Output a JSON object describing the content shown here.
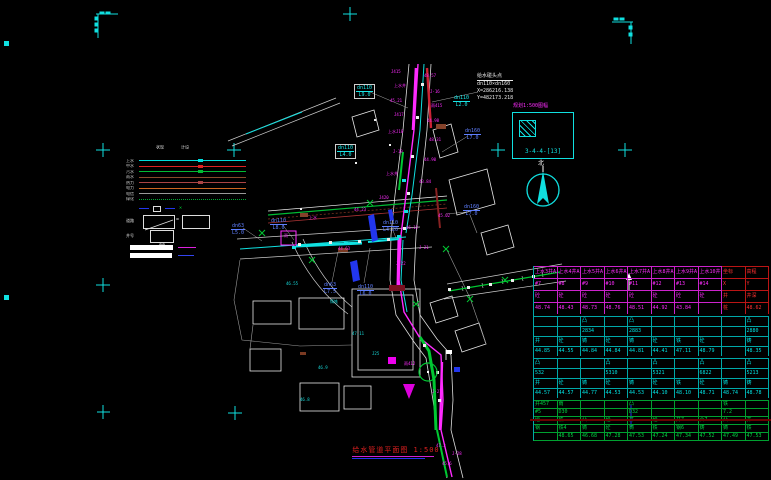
{
  "title": {
    "text": "给水管道平面图 1:500"
  },
  "north": {
    "label": "北"
  },
  "note": {
    "lines": [
      "给水碰头点",
      "dn110×dn160",
      "X=286216.138",
      "Y=482173.218"
    ]
  },
  "detail_box": {
    "title": "规划1:500图幅",
    "label": "3-4-4-[13]"
  },
  "colors": {
    "cyan": "#10e0e0",
    "magenta": "#ff2bff",
    "green": "#00c832",
    "blue_label": "#5f7fff",
    "red": "#e02020",
    "maroon": "#6a0000"
  },
  "legend": {
    "headers": [
      "现状",
      "设计"
    ],
    "rows": [
      {
        "label": "上水",
        "color": "#00dddd",
        "style": "solid",
        "blob": true
      },
      {
        "label": "中水",
        "color": "#dd2222",
        "style": "solid",
        "blob": true
      },
      {
        "label": "污水",
        "color": "#00bb33",
        "style": "solid",
        "blob": true
      },
      {
        "label": "雨水",
        "color": "#8a4a2a",
        "style": "solid",
        "blob": false
      },
      {
        "label": "热力",
        "color": "#aa4444",
        "style": "solid",
        "blob": true
      },
      {
        "label": "电力",
        "color": "#cc6622",
        "style": "solid",
        "blob": false
      },
      {
        "label": "电信",
        "color": "#999999",
        "style": "solid",
        "blob": false
      },
      {
        "label": "绿化",
        "color": "#00aa33",
        "style": "dotted",
        "blob": false
      }
    ],
    "road_label": "道路",
    "well_row_label": "井号",
    "well_label": "AA",
    "equals": "="
  },
  "pipe_labels": [
    {
      "lines": [
        "dn63",
        "L5.0"
      ],
      "x": 231,
      "y": 223,
      "c": "blue"
    },
    {
      "lines": [
        "dn110",
        "L8.0"
      ],
      "x": 270,
      "y": 218,
      "c": "blue"
    },
    {
      "lines": [
        "dn110",
        "L4.20"
      ],
      "x": 382,
      "y": 220,
      "c": "blue"
    },
    {
      "lines": [
        "dn63",
        "L7.5"
      ],
      "x": 323,
      "y": 282,
      "c": "blue"
    },
    {
      "lines": [
        "dn110",
        "L6.0"
      ],
      "x": 357,
      "y": 284,
      "c": "blue"
    },
    {
      "lines": [
        "dn110",
        "L9.0"
      ],
      "x": 354,
      "y": 84,
      "c": "cyan",
      "boxed": true
    },
    {
      "lines": [
        "dn160",
        "L7.0"
      ],
      "x": 464,
      "y": 128,
      "c": "blue"
    },
    {
      "lines": [
        "dn160",
        "L7.0"
      ],
      "x": 463,
      "y": 204,
      "c": "blue"
    },
    {
      "lines": [
        "dn110",
        "L2.0"
      ],
      "x": 453,
      "y": 95,
      "c": "cyan"
    },
    {
      "lines": [
        "dn110",
        "L4.0"
      ],
      "x": 335,
      "y": 144,
      "c": "cyan",
      "boxed": true
    }
  ],
  "well_tags": [
    {
      "t": "J415",
      "x": 391,
      "y": 70
    },
    {
      "t": "48.57",
      "x": 424,
      "y": 74
    },
    {
      "t": "上水井",
      "x": 394,
      "y": 84
    },
    {
      "t": "J-16",
      "x": 430,
      "y": 90
    },
    {
      "t": "45.21",
      "x": 390,
      "y": 99
    },
    {
      "t": "雨415",
      "x": 431,
      "y": 104
    },
    {
      "t": "J417",
      "x": 394,
      "y": 113
    },
    {
      "t": "44.98",
      "x": 427,
      "y": 119
    },
    {
      "t": "上水J18",
      "x": 388,
      "y": 130
    },
    {
      "t": "48.31",
      "x": 429,
      "y": 138
    },
    {
      "t": "J-19",
      "x": 393,
      "y": 150
    },
    {
      "t": "44.90",
      "x": 424,
      "y": 158
    },
    {
      "t": "上水井",
      "x": 386,
      "y": 172
    },
    {
      "t": "43.84",
      "x": 419,
      "y": 180
    },
    {
      "t": "J420",
      "x": 379,
      "y": 196
    },
    {
      "t": "44.23",
      "x": 354,
      "y": 208
    },
    {
      "t": "上水",
      "x": 309,
      "y": 216
    },
    {
      "t": "46.12",
      "x": 406,
      "y": 226
    },
    {
      "t": "J-21",
      "x": 419,
      "y": 246
    },
    {
      "t": "45.02",
      "x": 438,
      "y": 214
    },
    {
      "t": "雨",
      "x": 284,
      "y": 234
    },
    {
      "t": "44.63",
      "x": 338,
      "y": 247
    },
    {
      "t": "J-22",
      "x": 396,
      "y": 262
    },
    {
      "t": "雨412",
      "x": 404,
      "y": 362
    },
    {
      "t": "J-27",
      "x": 432,
      "y": 390
    },
    {
      "t": "47.2",
      "x": 436,
      "y": 444
    },
    {
      "t": "J-28",
      "x": 452,
      "y": 452
    },
    {
      "t": "45.6",
      "x": 442,
      "y": 462
    }
  ],
  "cyan_tags": [
    {
      "t": "46.55",
      "x": 286,
      "y": 282
    },
    {
      "t": "铸铁",
      "x": 330,
      "y": 300
    },
    {
      "t": "47.11",
      "x": 352,
      "y": 332
    },
    {
      "t": "J25",
      "x": 372,
      "y": 352
    },
    {
      "t": "46.9",
      "x": 318,
      "y": 366
    },
    {
      "t": "46.8",
      "x": 300,
      "y": 398
    }
  ],
  "table": {
    "sections": [
      {
        "color": "#ff2bff",
        "border": "#cc22cc",
        "red_cols": true,
        "row_h": 11,
        "rows": [
          [
            "上水3井A",
            "上水4井A",
            "上水5井A",
            "上水6井A",
            "上水7井A",
            "上水8井A",
            "上水9井A",
            "上水10井",
            "坐标",
            "高程"
          ],
          [
            "#7",
            "#8",
            "#9",
            "#10",
            "#11",
            "#12",
            "#13",
            "#14",
            "X",
            "Y"
          ],
          [
            "砼",
            "砼",
            "砼",
            "砼",
            "砼",
            "砼",
            "砼",
            "砼",
            "井",
            "井深"
          ],
          [
            "48.74",
            "48.43",
            "48.73",
            "48.76",
            "48.51",
            "44.92",
            "43.84",
            "",
            "桩",
            "48.62"
          ]
        ]
      },
      {
        "color": "#00e0e0",
        "border": "#00a8a8",
        "red_cols": false,
        "row_h": 9,
        "rows": [
          [
            "",
            "",
            "凸",
            "",
            "凸",
            "",
            "",
            "",
            "",
            "凸"
          ],
          [
            "",
            "",
            "2834",
            "",
            "2883",
            "",
            "",
            "",
            "",
            "2880"
          ],
          [
            "井",
            "砼",
            "铸",
            "砼",
            "铸",
            "砼",
            "铁",
            "砼",
            "",
            "铸"
          ],
          [
            "44.85",
            "44.55",
            "44.84",
            "44.84",
            "44.81",
            "44.41",
            "47.11",
            "48.79",
            "",
            "48.35"
          ]
        ]
      },
      {
        "color": "#00e0e0",
        "border": "#00a8a8",
        "red_cols": false,
        "row_h": 9,
        "rows": [
          [
            "凸",
            "",
            "",
            "凸",
            "",
            "凸",
            "",
            "凸",
            "",
            "凸"
          ],
          [
            "532",
            "",
            "",
            "5310",
            "",
            "5321",
            "",
            "6822",
            "",
            "5213"
          ],
          [
            "井",
            "砼",
            "铸",
            "砼",
            "铸",
            "砼",
            "铁",
            "砼",
            "铸",
            "铸"
          ],
          [
            "44.57",
            "44.57",
            "44.77",
            "44.53",
            "44.53",
            "44.10",
            "48.10",
            "48.71",
            "48.74",
            "48.78"
          ]
        ]
      },
      {
        "color": "#00d040",
        "border": "#00a030",
        "red_cols": false,
        "row_h": 7,
        "rows": [
          [
            "井457",
            "雨",
            "",
            "",
            "凸",
            "",
            "",
            "",
            "铁",
            ""
          ],
          [
            "#5",
            "D30",
            "",
            "",
            "D32",
            "",
            "",
            "",
            "7.2",
            ""
          ],
          [
            "砼",
            "铁",
            "凸",
            "砼",
            "井",
            "砼",
            "井7",
            "凸7",
            "凸",
            "井"
          ],
          [
            "钢",
            "铁4",
            "铸",
            "砼",
            "铸",
            "铁",
            "钢6",
            "铸",
            "铸",
            "铁"
          ],
          [
            "",
            "48.65",
            "46.68",
            "47.28",
            "47.53",
            "47.24",
            "47.34",
            "47.52",
            "47.49",
            "47.53"
          ]
        ]
      }
    ]
  }
}
